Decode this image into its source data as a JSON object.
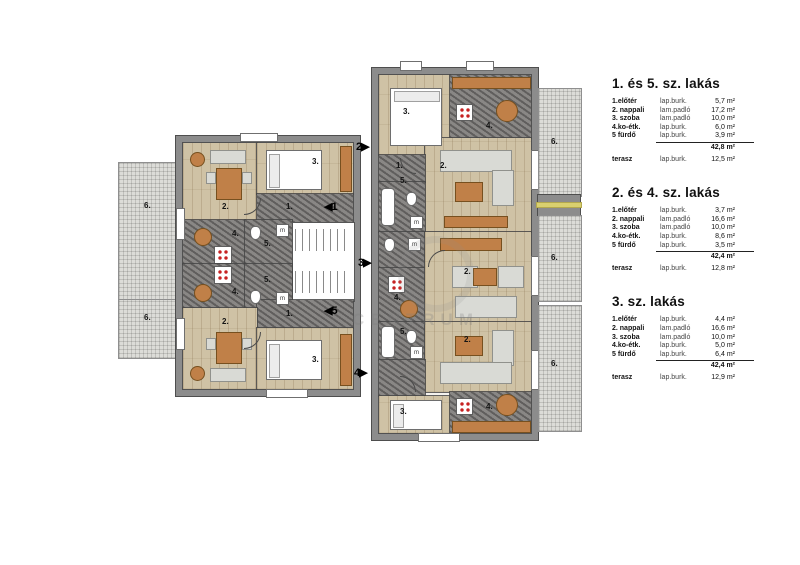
{
  "legend": {
    "blocks": [
      {
        "title": "1. és 5. sz. lakás",
        "rows": [
          {
            "name": "1.előtér",
            "finish": "lap.burk.",
            "area": "5,7 m²"
          },
          {
            "name": "2. nappali",
            "finish": "lam.padló",
            "area": "17,2 m²"
          },
          {
            "name": "3. szoba",
            "finish": "lam.padló",
            "area": "10,0 m²"
          },
          {
            "name": "4.ko-étk.",
            "finish": "lap.burk.",
            "area": "6,0 m²"
          },
          {
            "name": "5 fürdő",
            "finish": "lap.burk.",
            "area": "3,9 m²"
          }
        ],
        "total": "42,8 m²",
        "terrace": {
          "name": "terasz",
          "finish": "lap.burk.",
          "area": "12,5 m²"
        }
      },
      {
        "title": "2. és 4. sz. lakás",
        "rows": [
          {
            "name": "1.előtér",
            "finish": "lap.burk.",
            "area": "3,7 m²"
          },
          {
            "name": "2. nappali",
            "finish": "lam.padló",
            "area": "16,6 m²"
          },
          {
            "name": "3. szoba",
            "finish": "lam.padló",
            "area": "10,0 m²"
          },
          {
            "name": "4.ko-étk.",
            "finish": "lap.burk.",
            "area": "8,6 m²"
          },
          {
            "name": "5 fürdő",
            "finish": "lap.burk.",
            "area": "3,5 m²"
          }
        ],
        "total": "42,4 m²",
        "terrace": {
          "name": "terasz",
          "finish": "lap.burk.",
          "area": "12,8 m²"
        }
      },
      {
        "title": "3. sz. lakás",
        "rows": [
          {
            "name": "1.előtér",
            "finish": "lap.burk.",
            "area": "4,4 m²"
          },
          {
            "name": "2. nappali",
            "finish": "lam.padló",
            "area": "16,6 m²"
          },
          {
            "name": "3. szoba",
            "finish": "lam.padló",
            "area": "10,0 m²"
          },
          {
            "name": "4.ko-étk.",
            "finish": "lap.burk.",
            "area": "5,0 m²"
          },
          {
            "name": "5 fürdő",
            "finish": "lap.burk.",
            "area": "6,4 m²"
          }
        ],
        "total": "42,4 m²",
        "terrace": {
          "name": "terasz",
          "finish": "lap.burk.",
          "area": "12,9 m²"
        }
      }
    ]
  },
  "plan": {
    "room_numbers": {
      "entry": "1.",
      "living": "2.",
      "bedroom": "3.",
      "kitchen": "4.",
      "bath": "5.",
      "terrace": "6."
    },
    "entry_arrows": {
      "apt1": "◀1",
      "apt2": "2▶",
      "apt3": "3▶",
      "apt4": "4▶",
      "apt5": "◀5"
    },
    "washer_label": "m",
    "watermark": "CENTRUM",
    "colors": {
      "wall": "#8c8c8c",
      "wood_floor": "#cfc2a5",
      "tile_floor": "#807e7c",
      "terrace": "#dcdcd8",
      "furniture_accent": "#c08048",
      "stove_dots": "#c62222"
    }
  }
}
